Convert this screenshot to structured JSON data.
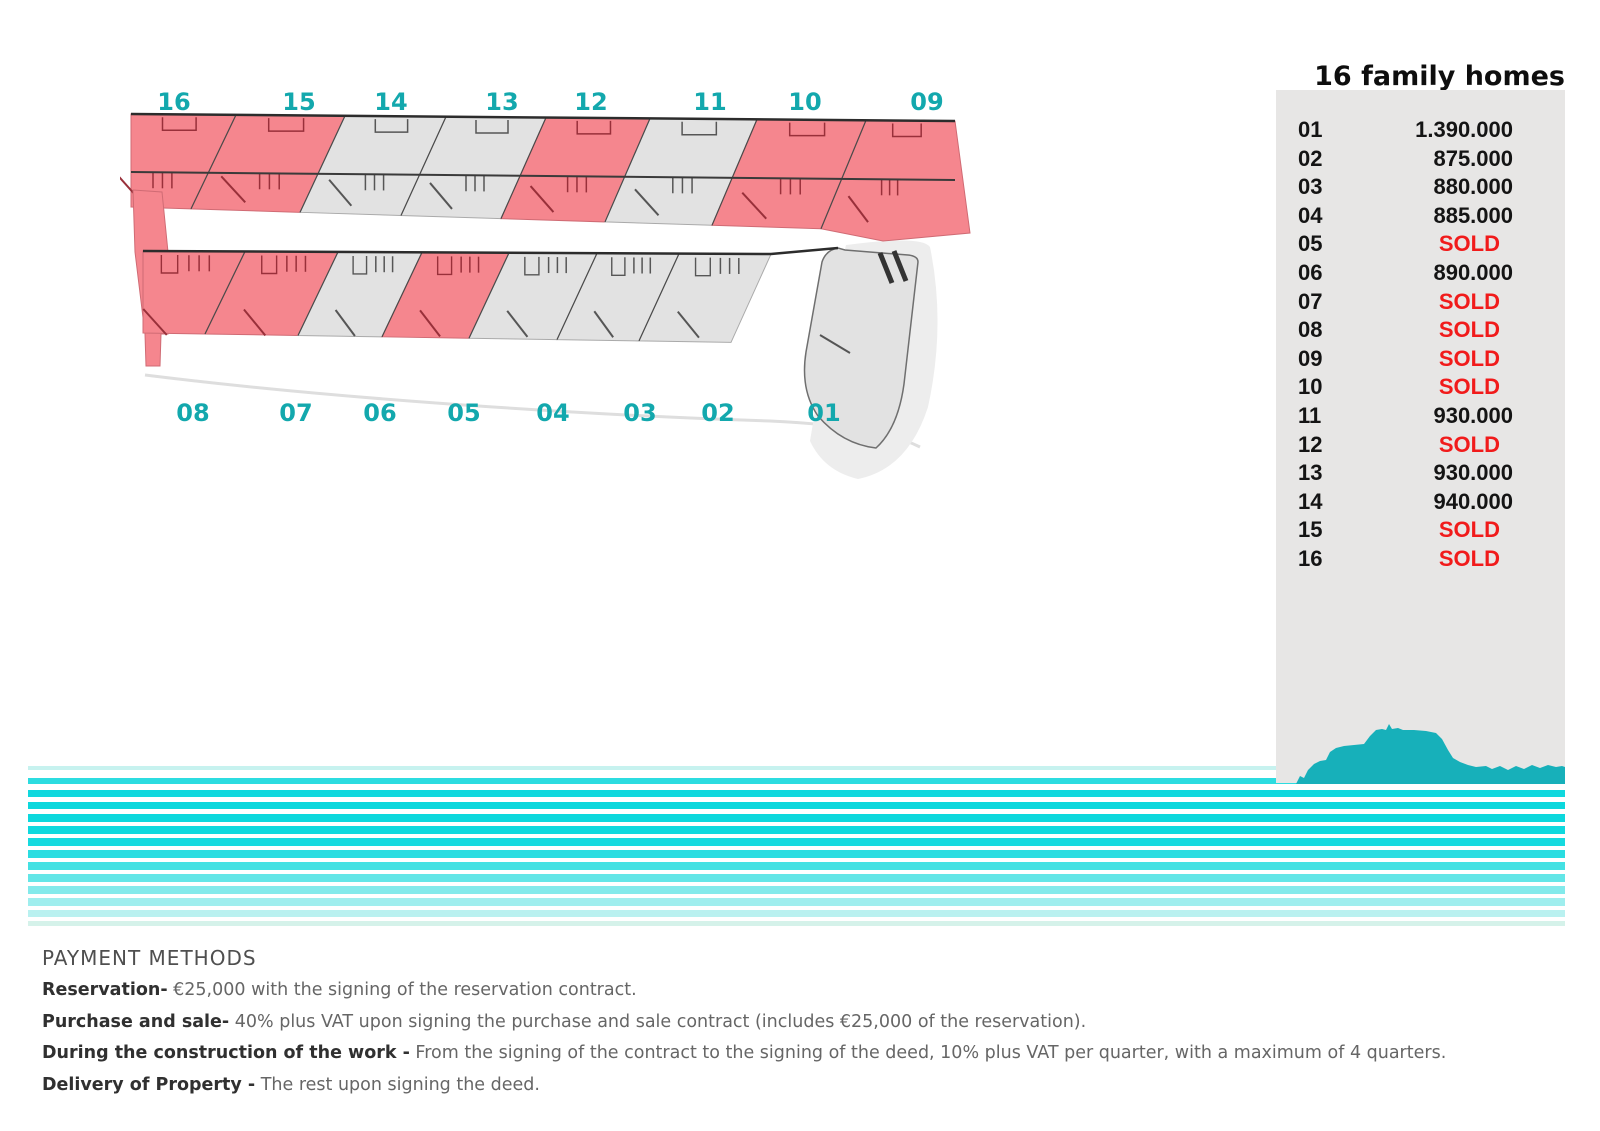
{
  "title": "16 family homes",
  "price_list": {
    "rows": [
      {
        "unit": "01",
        "value": "1.390.000",
        "sold": false
      },
      {
        "unit": "02",
        "value": "875.000",
        "sold": false
      },
      {
        "unit": "03",
        "value": "880.000",
        "sold": false
      },
      {
        "unit": "04",
        "value": "885.000",
        "sold": false
      },
      {
        "unit": "05",
        "value": "SOLD",
        "sold": true
      },
      {
        "unit": "06",
        "value": "890.000",
        "sold": false
      },
      {
        "unit": "07",
        "value": "SOLD",
        "sold": true
      },
      {
        "unit": "08",
        "value": "SOLD",
        "sold": true
      },
      {
        "unit": "09",
        "value": "SOLD",
        "sold": true
      },
      {
        "unit": "10",
        "value": "SOLD",
        "sold": true
      },
      {
        "unit": "11",
        "value": "930.000",
        "sold": false
      },
      {
        "unit": "12",
        "value": "SOLD",
        "sold": true
      },
      {
        "unit": "13",
        "value": "930.000",
        "sold": false
      },
      {
        "unit": "14",
        "value": "940.000",
        "sold": false
      },
      {
        "unit": "15",
        "value": "SOLD",
        "sold": true
      },
      {
        "unit": "16",
        "value": "SOLD",
        "sold": true
      }
    ]
  },
  "site_plan": {
    "top_row_labels": [
      "16",
      "15",
      "14",
      "13",
      "12",
      "11",
      "10",
      "09"
    ],
    "bottom_row_labels": [
      "08",
      "07",
      "06",
      "05",
      "04",
      "03",
      "02",
      "01"
    ],
    "colors": {
      "sold_fill": "#f5868e",
      "available_fill": "#e2e2e2",
      "label": "#13a8ad",
      "sold_line": "#99303a",
      "available_line": "#565656"
    }
  },
  "payment_methods": {
    "heading": "PAYMENT METHODS",
    "items": [
      {
        "lead": "Reservation-",
        "rest": " €25,000 with the signing of the reservation contract."
      },
      {
        "lead": "Purchase and sale-",
        "rest": " 40% plus VAT upon signing the purchase and sale contract (includes €25,000 of the reservation)."
      },
      {
        "lead": "During the construction of the work -",
        "rest": " From the signing of the contract to the signing of the deed, 10% plus VAT per quarter, with a maximum of 4 quarters."
      },
      {
        "lead": "Delivery of Property -",
        "rest": " The rest upon signing the deed."
      }
    ]
  },
  "colors": {
    "sold_text": "#f11b1b",
    "price_text": "#141414",
    "panel_bg": "#e7e6e5",
    "mountain_teal": "#17b0ba",
    "stripe_cyan": "#0cd8dd"
  }
}
